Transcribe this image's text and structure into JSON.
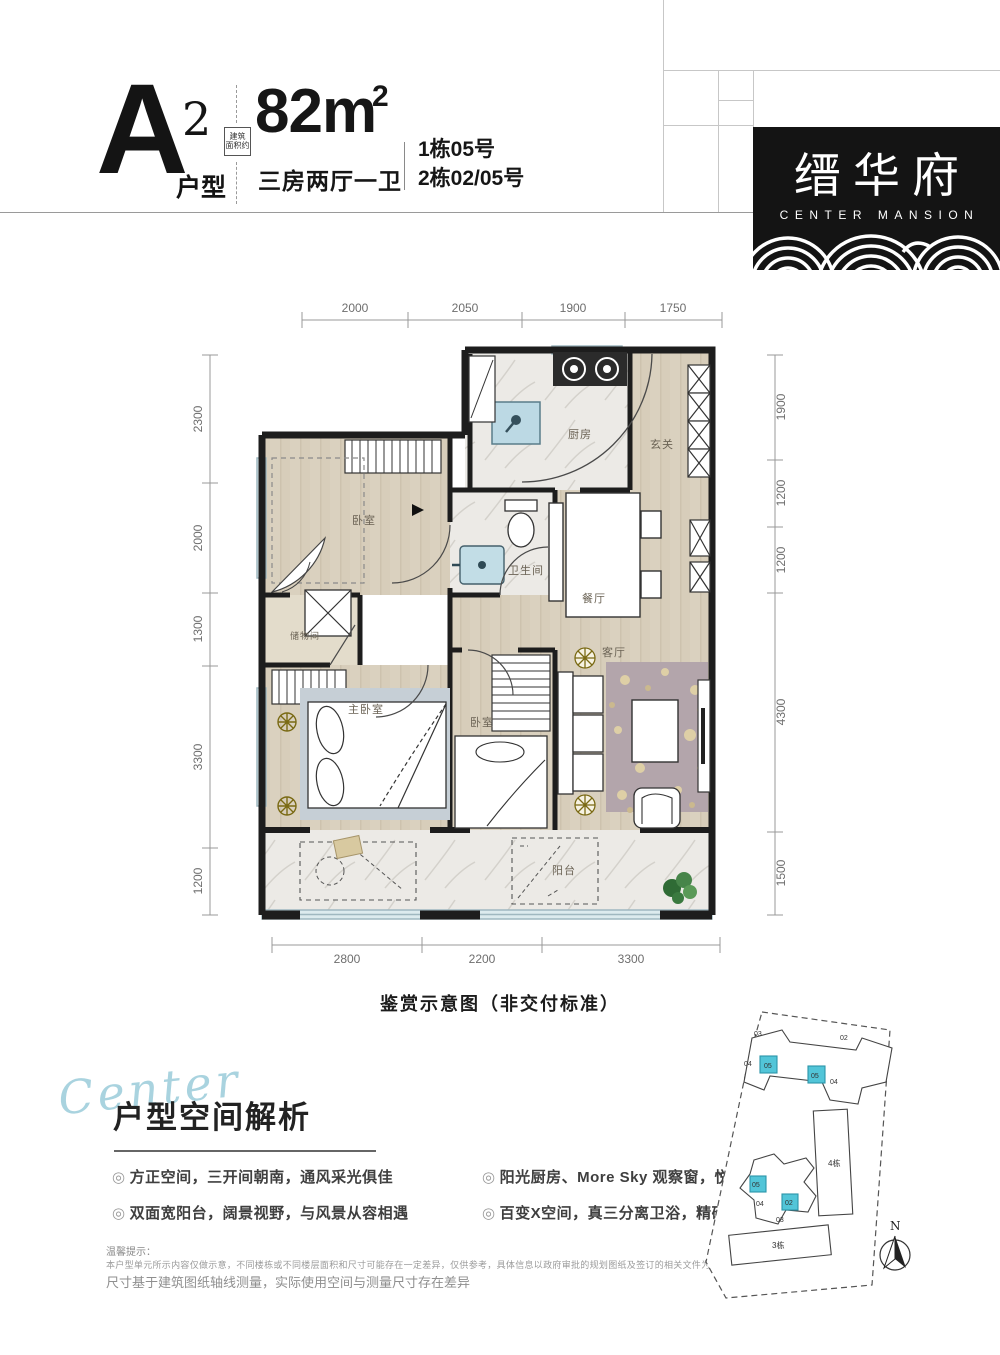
{
  "header": {
    "unit_letter": "A",
    "unit_sup": "2",
    "unit_type_label": "户型",
    "stamp_line1": "建筑",
    "stamp_line2": "面积约",
    "area": "82m",
    "area_sup": "2",
    "rooms": "三房两厅一卫",
    "building_line1": "1栋05号",
    "building_line2": "2栋02/05号"
  },
  "logo": {
    "name_cn": "缙华府",
    "name_en": "CENTER MANSION"
  },
  "floorplan": {
    "caption": "鉴赏示意图（非交付标准）",
    "dims_top": [
      "2000",
      "2050",
      "1900",
      "1750"
    ],
    "dims_left": [
      "2300",
      "2000",
      "1300",
      "3300",
      "1200"
    ],
    "dims_right": [
      "1900",
      "1200",
      "1200",
      "4300",
      "1500"
    ],
    "dims_bottom": [
      "2800",
      "2200",
      "3300"
    ],
    "rooms": {
      "kitchen": "厨房",
      "entry": "玄关",
      "bedroom1": "卧室",
      "bath": "卫生间",
      "dining": "餐厅",
      "storage": "储物间",
      "master": "主卧室",
      "bedroom2": "卧室",
      "living": "客厅",
      "balcony": "阳台"
    }
  },
  "analysis": {
    "script_word": "Center",
    "title": "户型空间解析",
    "bullets": [
      "方正空间，三开间朝南，通风采光俱佳",
      "阳光厨房、More Sky 观察窗，悦享互动",
      "双面宽阳台，阔景视野，与风景从容相遇",
      "百变X空间，真三分离卫浴，精研品质生活"
    ],
    "disclaimer_title": "温馨提示：",
    "disclaimer_line1": "本户型单元所示内容仅做示意，不同楼栋或不同楼层面积和尺寸可能存在一定差异，仅供参考，具体信息以政府审批的规划图纸及签订的相关文件为准，",
    "disclaimer_line2": "尺寸基于建筑图纸轴线测量，实际使用空间与测量尺寸存在差异"
  },
  "siteplan": {
    "building_labels": [
      "4栋",
      "3栋"
    ],
    "compass": "N",
    "top_units": [
      "03",
      "02",
      "04",
      "05",
      "05",
      "04"
    ],
    "bottom_units": [
      "05",
      "04",
      "02",
      "03"
    ]
  },
  "colors": {
    "highlight_cyan": "#52c5d8",
    "wood_floor": "#d7cdba",
    "wall_black": "#1d1d1d",
    "script_blue": "#a9d3df"
  }
}
